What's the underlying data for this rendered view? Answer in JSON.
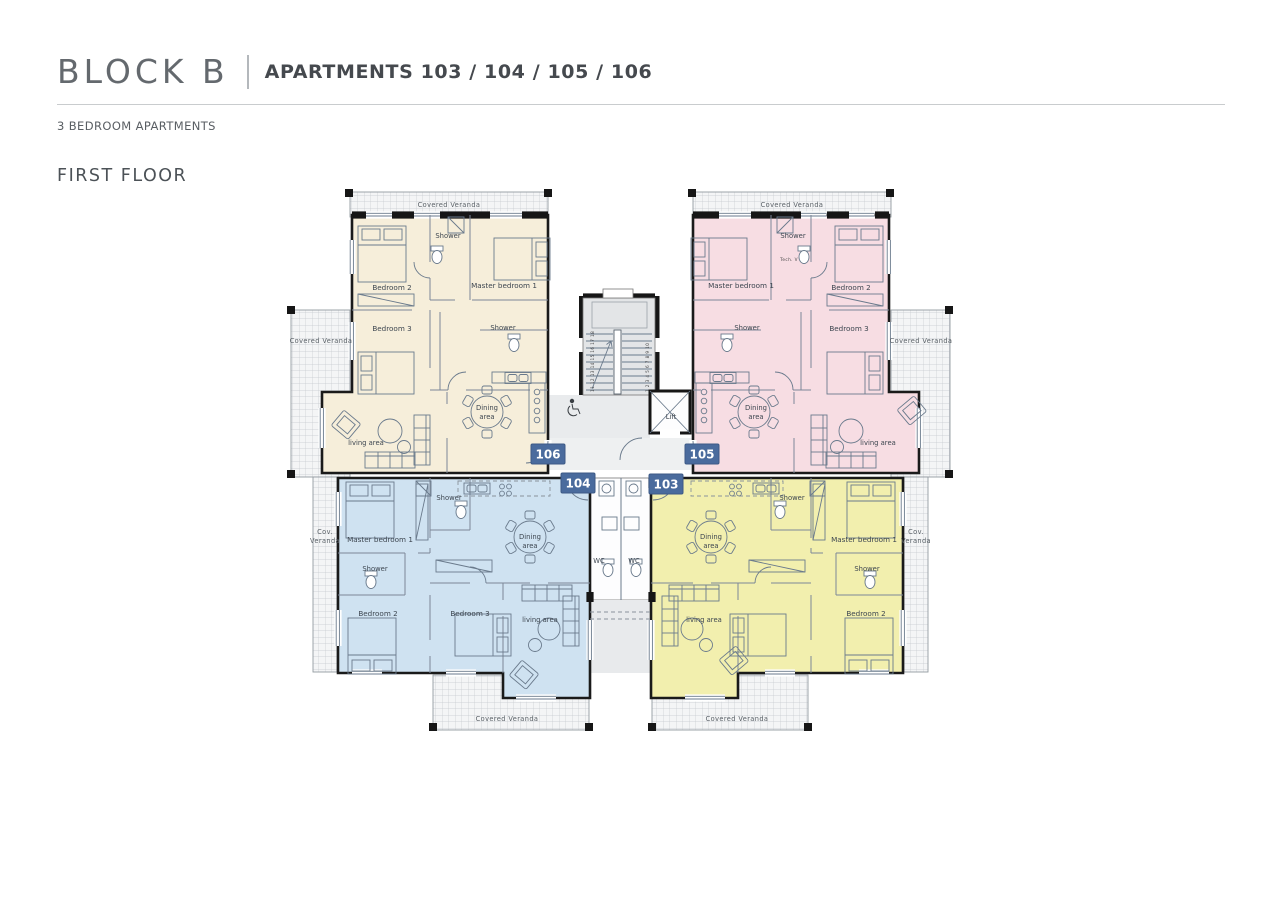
{
  "header": {
    "block": "BLOCK B",
    "subtitle": "APARTMENTS 103 / 104 / 105 / 106",
    "type_label": "3 BEDROOM APARTMENTS",
    "floor_label": "FIRST FLOOR"
  },
  "labels": {
    "covered_veranda": "Covered Veranda",
    "cov1": "Cov.",
    "cov2": "Veranda",
    "master": "Master bedroom 1",
    "bed2": "Bedroom 2",
    "bed3": "Bedroom 3",
    "shower": "Shower",
    "dining1": "Dining",
    "dining2": "area",
    "living": "living area",
    "wc": "WC",
    "lift": "Lift",
    "tech": "Tech. V",
    "stairs_a": "1 2 3 4 5 6 7 8 9 10",
    "stairs_b": "11 12 13 14 15 16 17 18"
  },
  "badges": {
    "a106": "106",
    "a105": "105",
    "a104": "104",
    "a103": "103"
  },
  "colors": {
    "cream": "#f6eeda",
    "pink": "#f7dde3",
    "blue": "#cfe2f1",
    "yellow": "#f2efae",
    "badge": "#4a6b9d"
  }
}
